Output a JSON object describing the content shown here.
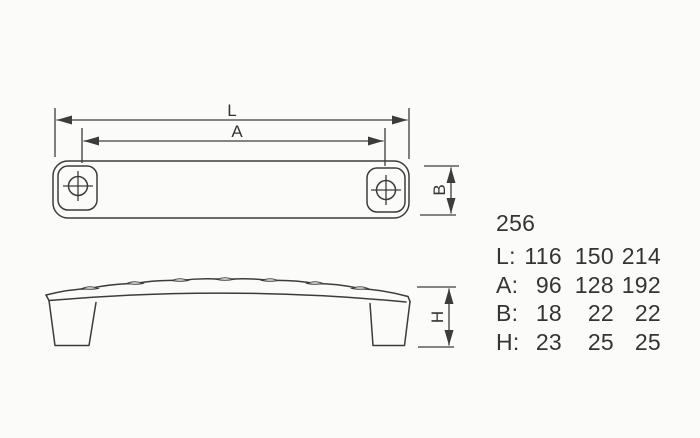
{
  "drawing": {
    "dimension_labels": {
      "length": "L",
      "hole_spacing": "A",
      "width": "B",
      "height": "H"
    },
    "spec_table": {
      "model": "256",
      "rows": [
        {
          "label": "L:",
          "values": [
            "116",
            "150",
            "214"
          ]
        },
        {
          "label": "A:",
          "values": [
            "96",
            "128",
            "192"
          ]
        },
        {
          "label": "B:",
          "values": [
            "18",
            "22",
            "22"
          ]
        },
        {
          "label": "H:",
          "values": [
            "23",
            "25",
            "25"
          ]
        }
      ]
    },
    "colors": {
      "line": "#3c3c3c",
      "text": "#343434",
      "background": "#fbfbf9"
    }
  }
}
